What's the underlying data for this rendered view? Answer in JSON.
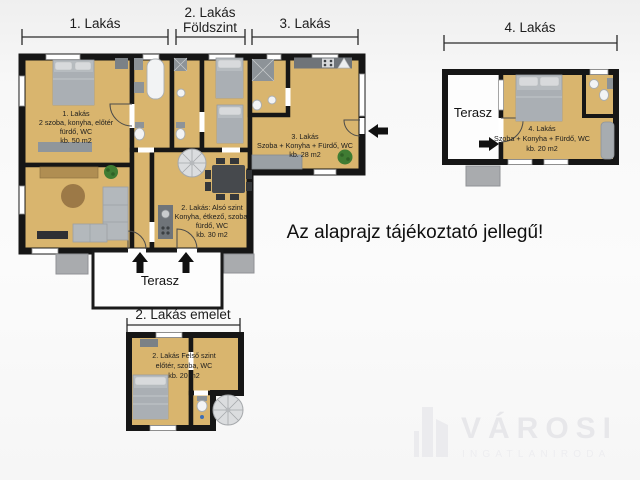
{
  "meta": {
    "disclaimer": "Az alaprajz tájékoztató jellegű!"
  },
  "dimensions": {
    "unit1": "1. Lakás",
    "unit2_line1": "2. Lakás",
    "unit2_line2": "Földszint",
    "unit3": "3. Lakás",
    "unit4": "4. Lakás",
    "unit2_upper": "2. Lakás emelet"
  },
  "rooms": {
    "unit1": {
      "lines": [
        "1. Lakás",
        "2 szoba, konyha, előtér",
        "fürdő, WC",
        "kb. 50 m2"
      ]
    },
    "unit2_lower": {
      "lines": [
        "2. Lakás:  Alsó szint",
        "Konyha, étkező, szoba,",
        "fürdő, WC",
        "kb. 30 m2"
      ]
    },
    "unit3": {
      "lines": [
        "3. Lakás",
        "Szoba + Konyha + Fürdő, WC",
        "kb. 28 m2"
      ]
    },
    "unit4": {
      "lines": [
        "4. Lakás",
        "Szoba + Konyha + Fürdő, WC",
        "kb. 20 m2"
      ]
    },
    "unit2_upper": {
      "lines": [
        "2. Lakás Felső szint",
        "előtér, szoba, WC",
        "kb. 20 m2"
      ]
    },
    "terasz_main": "Terasz",
    "terasz_unit4": "Terasz"
  },
  "logo": {
    "brand": "VÁROSI",
    "subtitle": "INGATLANIRODA"
  },
  "colors": {
    "room_fill": "#d9b56e",
    "wall": "#161616",
    "terrace_fill": "#fdfdfd",
    "furniture_gray": "#b7bcc0",
    "counter_gray": "#6f7479",
    "step_gray": "#a9abae",
    "plant_green": "#3f7c33",
    "arrow_black": "#111111",
    "logo_gray": "#e7e7ea",
    "background": "#f4f4f4"
  }
}
